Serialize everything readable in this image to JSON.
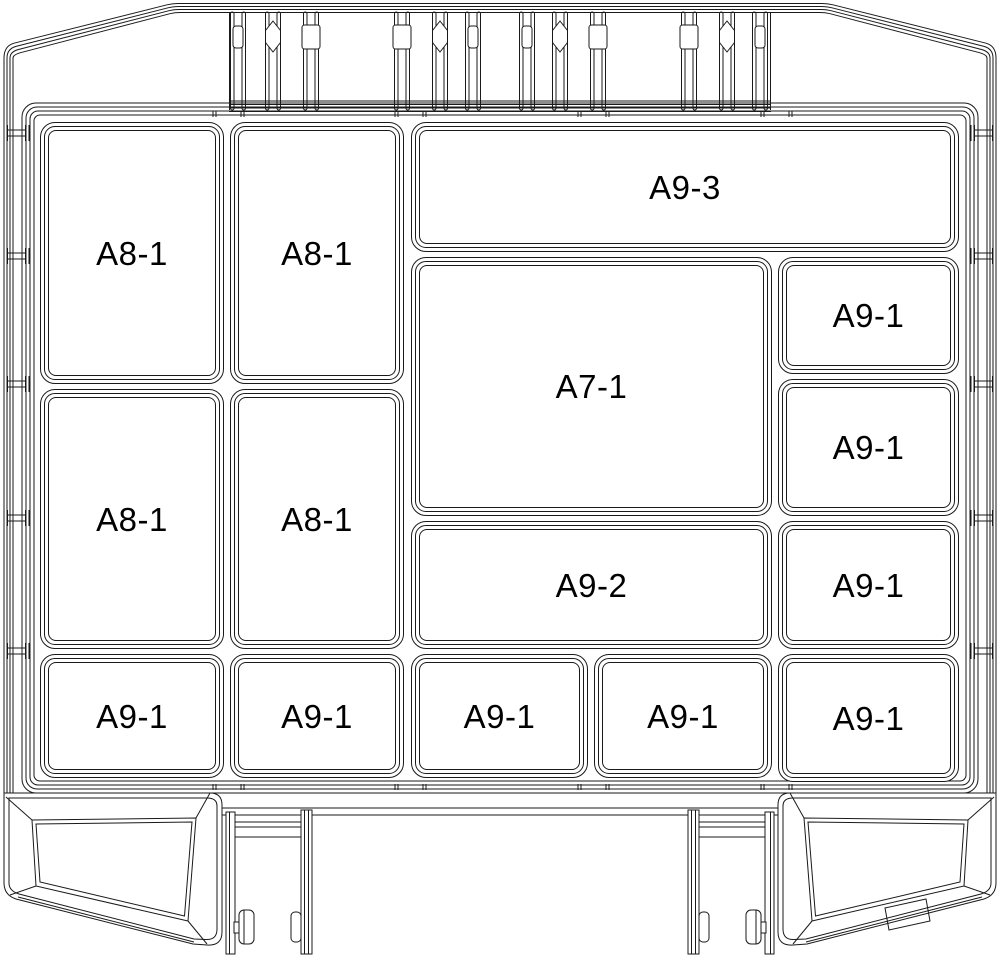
{
  "colors": {
    "line": "#1a1a1a",
    "background": "#ffffff"
  },
  "compartments": [
    {
      "id": "top-wide",
      "label": "A9-3"
    },
    {
      "id": "col1-row1",
      "label": "A8-1"
    },
    {
      "id": "col2-row1",
      "label": "A8-1"
    },
    {
      "id": "center-large",
      "label": "A7-1"
    },
    {
      "id": "right-row1",
      "label": "A9-1"
    },
    {
      "id": "col1-row2",
      "label": "A8-1"
    },
    {
      "id": "col2-row2",
      "label": "A8-1"
    },
    {
      "id": "right-row2",
      "label": "A9-1"
    },
    {
      "id": "center-wide",
      "label": "A9-2"
    },
    {
      "id": "right-row3",
      "label": "A9-1"
    },
    {
      "id": "bottom-col1",
      "label": "A9-1"
    },
    {
      "id": "bottom-col2",
      "label": "A9-1"
    },
    {
      "id": "bottom-mid1",
      "label": "A9-1"
    },
    {
      "id": "bottom-mid2",
      "label": "A9-1"
    },
    {
      "id": "right-row4",
      "label": "A9-1"
    }
  ]
}
